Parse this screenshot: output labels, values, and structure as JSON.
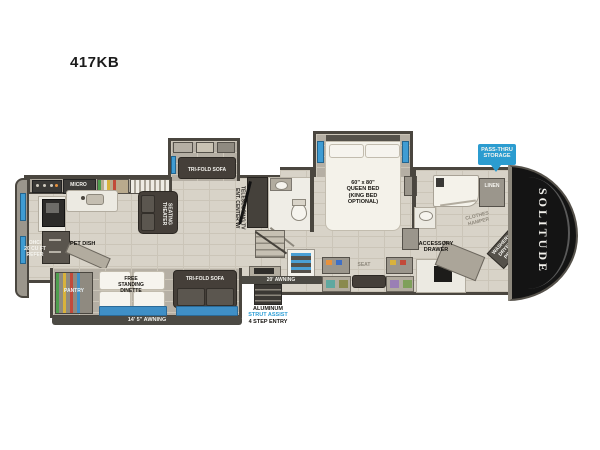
{
  "title": "417KB",
  "colors": {
    "accent_blue": "#3f9cd3",
    "badge_blue": "#2b9cd0",
    "entry_text_blue": "#2f9fd6",
    "wall": "#4a463f",
    "floor": "#d8d3c8",
    "front_cap": "#141414"
  },
  "labels": {
    "micro": "MICRO",
    "theater": [
      "THEATER",
      "SEATING"
    ],
    "tri_fold_sofa_top": "TRI-FOLD SOFA",
    "ent_center": [
      "ENT. CENTER W/",
      "TELESCOPING TV"
    ],
    "queen_bed": [
      "60\" x 80\"",
      "QUEEN BED",
      "(KING BED",
      "OPTIONAL)"
    ],
    "refer": [
      "OHC/",
      "20 CU FT",
      "REFER"
    ],
    "pet_dish": "PET DISH",
    "pantry": "PANTRY",
    "dinette": [
      "FREE",
      "STANDING",
      "DINETTE"
    ],
    "tri_fold_sofa_bottom": "TRI-FOLD SOFA",
    "awning_main": "14' 5\" AWNING",
    "awning_door": "20' AWNING",
    "entry": [
      "ALUMINUM",
      "STRUT ASSIST",
      "4 STEP ENTRY"
    ],
    "seat": "SEAT",
    "accessory_drawer": [
      "ACCESSORY",
      "DRAWER"
    ],
    "clothes_hamper": [
      "CLOTHES",
      "HAMPER"
    ],
    "washer_dryer": [
      "WASHER/",
      "DRYER",
      "PREP"
    ],
    "linen": "LINEN",
    "pass_thru": [
      "PASS-THRU",
      "STORAGE"
    ],
    "brand": "SOLITUDE"
  }
}
